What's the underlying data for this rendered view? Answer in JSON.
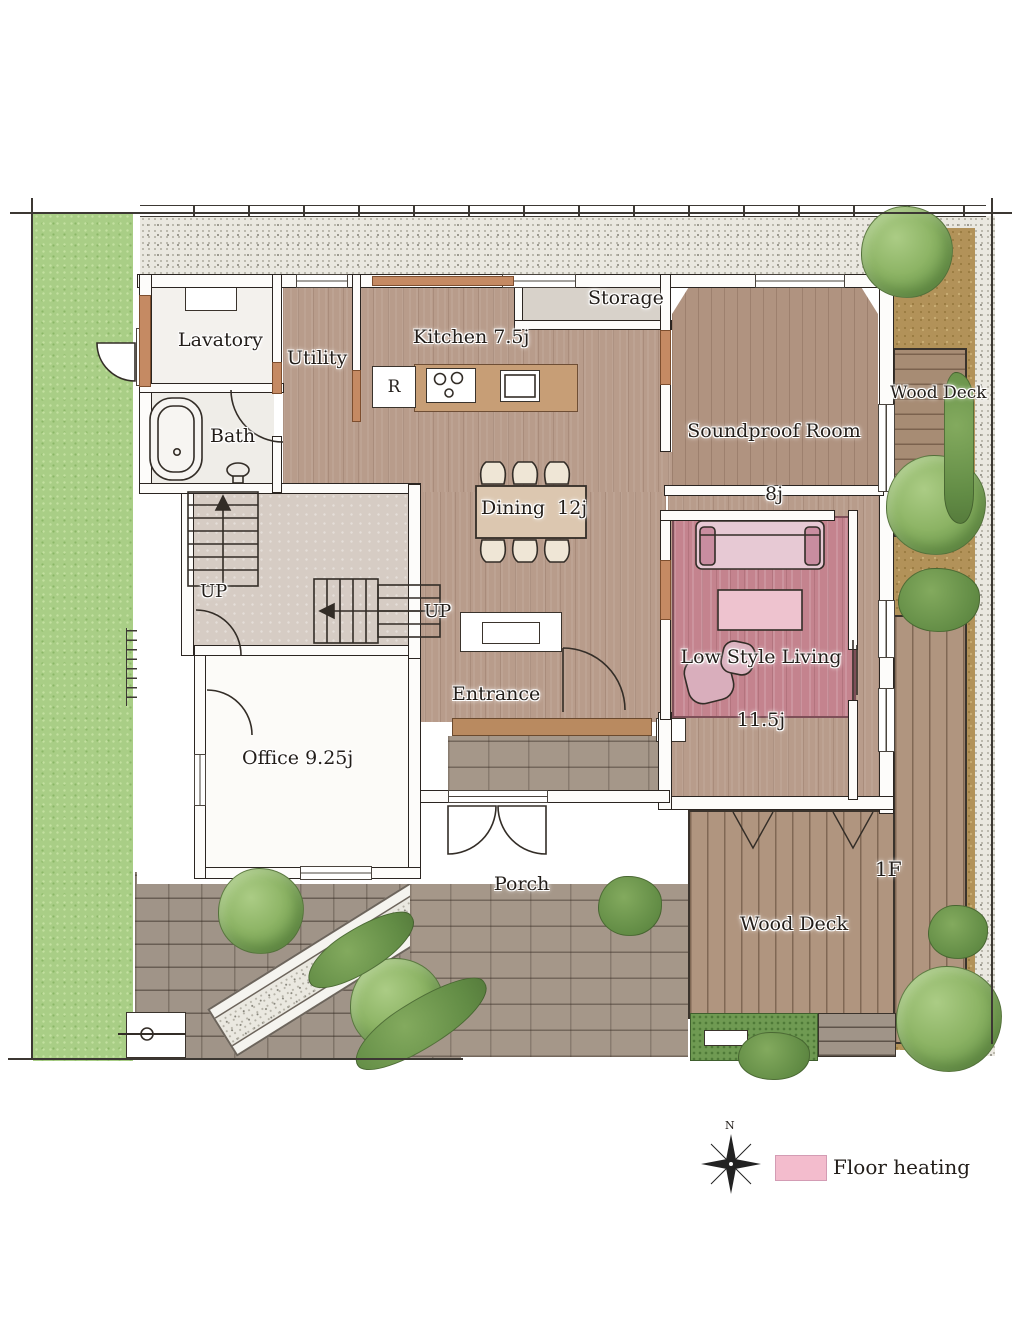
{
  "plan": {
    "floor": "1F",
    "labels": {
      "lavatory": "Lavatory",
      "utility": "Utility",
      "kitchen": "Kitchen 7.5j",
      "storage": "Storage",
      "soundproof_line1": "Soundproof Room",
      "soundproof_line2": "8j",
      "wood_deck_east": "Wood Deck",
      "bath": "Bath",
      "dining": "Dining  12j",
      "up_west": "UP",
      "up_center": "UP",
      "living_line1": "Low Style Living",
      "living_line2": "11.5j",
      "entrance": "Entrance",
      "office": "Office 9.25j",
      "porch": "Porch",
      "wood_deck_south": "Wood Deck",
      "refrigerator": "R"
    },
    "legend": {
      "floor_heating_label": "Floor heating",
      "floor_heating_color": "#f3bccd"
    },
    "compass": {
      "north": "N"
    },
    "colors": {
      "wood_floor": "#b89c8b",
      "floor_heating_rug": "#c4838e",
      "lawn": "#a9ce86",
      "deck": "#b0957f",
      "brick": "#a59789",
      "gravel": "#eae8e0",
      "accent_wall": "#c58a63"
    }
  }
}
